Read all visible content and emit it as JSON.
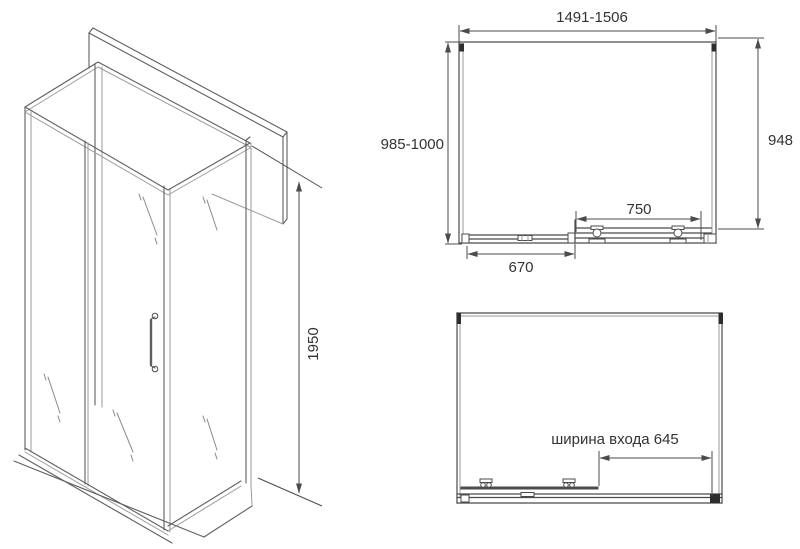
{
  "drawing": {
    "perspective_view": {
      "height_label": "1950"
    },
    "front_view": {
      "width_label": "1491-1506",
      "left_height_label": "985-1000",
      "right_height_label": "948",
      "door_track_label": "750",
      "lower_rail_label": "670"
    },
    "plan_view": {
      "entrance_width_label": "ширина входа 645"
    }
  },
  "colors": {
    "line": "#4b4b4b",
    "glass_line": "#9a9a9a",
    "text": "#333333",
    "background": "#ffffff"
  }
}
